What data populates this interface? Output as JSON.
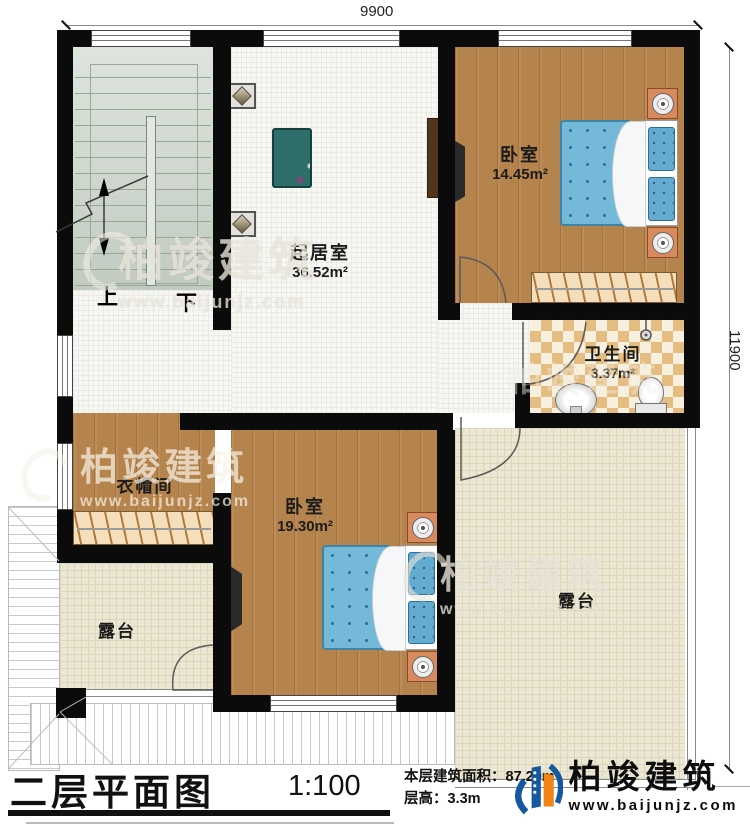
{
  "title": {
    "name": "二层平面图",
    "scale": "1:100",
    "area_label": "本层建筑面积：",
    "area_value": "87.20m²",
    "floor_height_label": "层高：",
    "floor_height_value": "3.3m"
  },
  "dimensions": {
    "width_mm": "9900",
    "height_mm": "11900"
  },
  "rooms": {
    "living": {
      "name": "起居室",
      "area": "36.52m²"
    },
    "bedroom1": {
      "name": "卧室",
      "area": "14.45m²"
    },
    "bedroom2": {
      "name": "卧室",
      "area": "19.30m²"
    },
    "bathroom": {
      "name": "卫生间",
      "area": "3.37m²"
    },
    "cloakroom": {
      "name": "衣帽间"
    },
    "terrace_left": {
      "name": "露台"
    },
    "terrace_right": {
      "name": "露台"
    }
  },
  "stairs": {
    "up_label": "上",
    "down_label": "下"
  },
  "branding": {
    "company": "柏竣建筑",
    "website": "www.baijunjz.com"
  },
  "watermark": {
    "text": "柏竣建筑",
    "url": "www.baijunjz.com"
  },
  "colors": {
    "wall": "#0b0b0b",
    "wood_floor": "#b5834c",
    "stair_floor": "#ccd6cb",
    "terrace_tile": "#ece7d3",
    "bed_blue": "#74b9d8",
    "logo_blue": "#1558a0",
    "logo_orange": "#f08418"
  }
}
